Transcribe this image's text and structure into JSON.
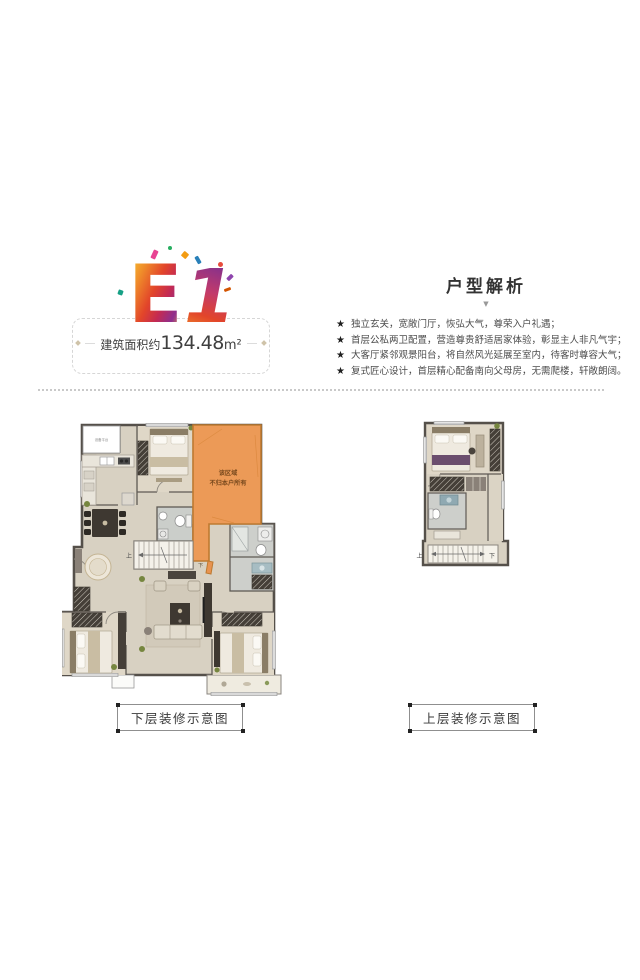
{
  "unit": {
    "model_letter": "E",
    "model_digit": "1",
    "area_prefix": "建筑面积约",
    "area_value": "134.48",
    "area_unit": "m²"
  },
  "analysis": {
    "title": "户型解析",
    "pointer_icon": "▼",
    "star": "★",
    "bullets": [
      "独立玄关，宽敞门厅，恢弘大气，尊荣入户礼遇；",
      "首层公私两卫配置，营造尊贵舒适居家体验，彰显主人非凡气宇；",
      "大客厅紧邻观景阳台，将自然风光延展至室内，待客时尊容大气；",
      "复式匠心设计，首层精心配备南向父母房，无需爬楼，轩敞朗阔。"
    ]
  },
  "plans": {
    "lower": {
      "caption": "下层装修示意图",
      "restricted_line1": "该区域",
      "restricted_line2": "不归本户所有",
      "stair_up_label": "上",
      "stair_down_label": "下",
      "platform_label": "设备平台"
    },
    "upper": {
      "caption": "上层装修示意图",
      "stair_up_label": "上",
      "stair_down_label": "下"
    }
  },
  "colors": {
    "restricted_fill": "#EC9A57",
    "restricted_border": "#BE7A30",
    "wall": "#55504A",
    "floor": "#D8D1C2"
  }
}
